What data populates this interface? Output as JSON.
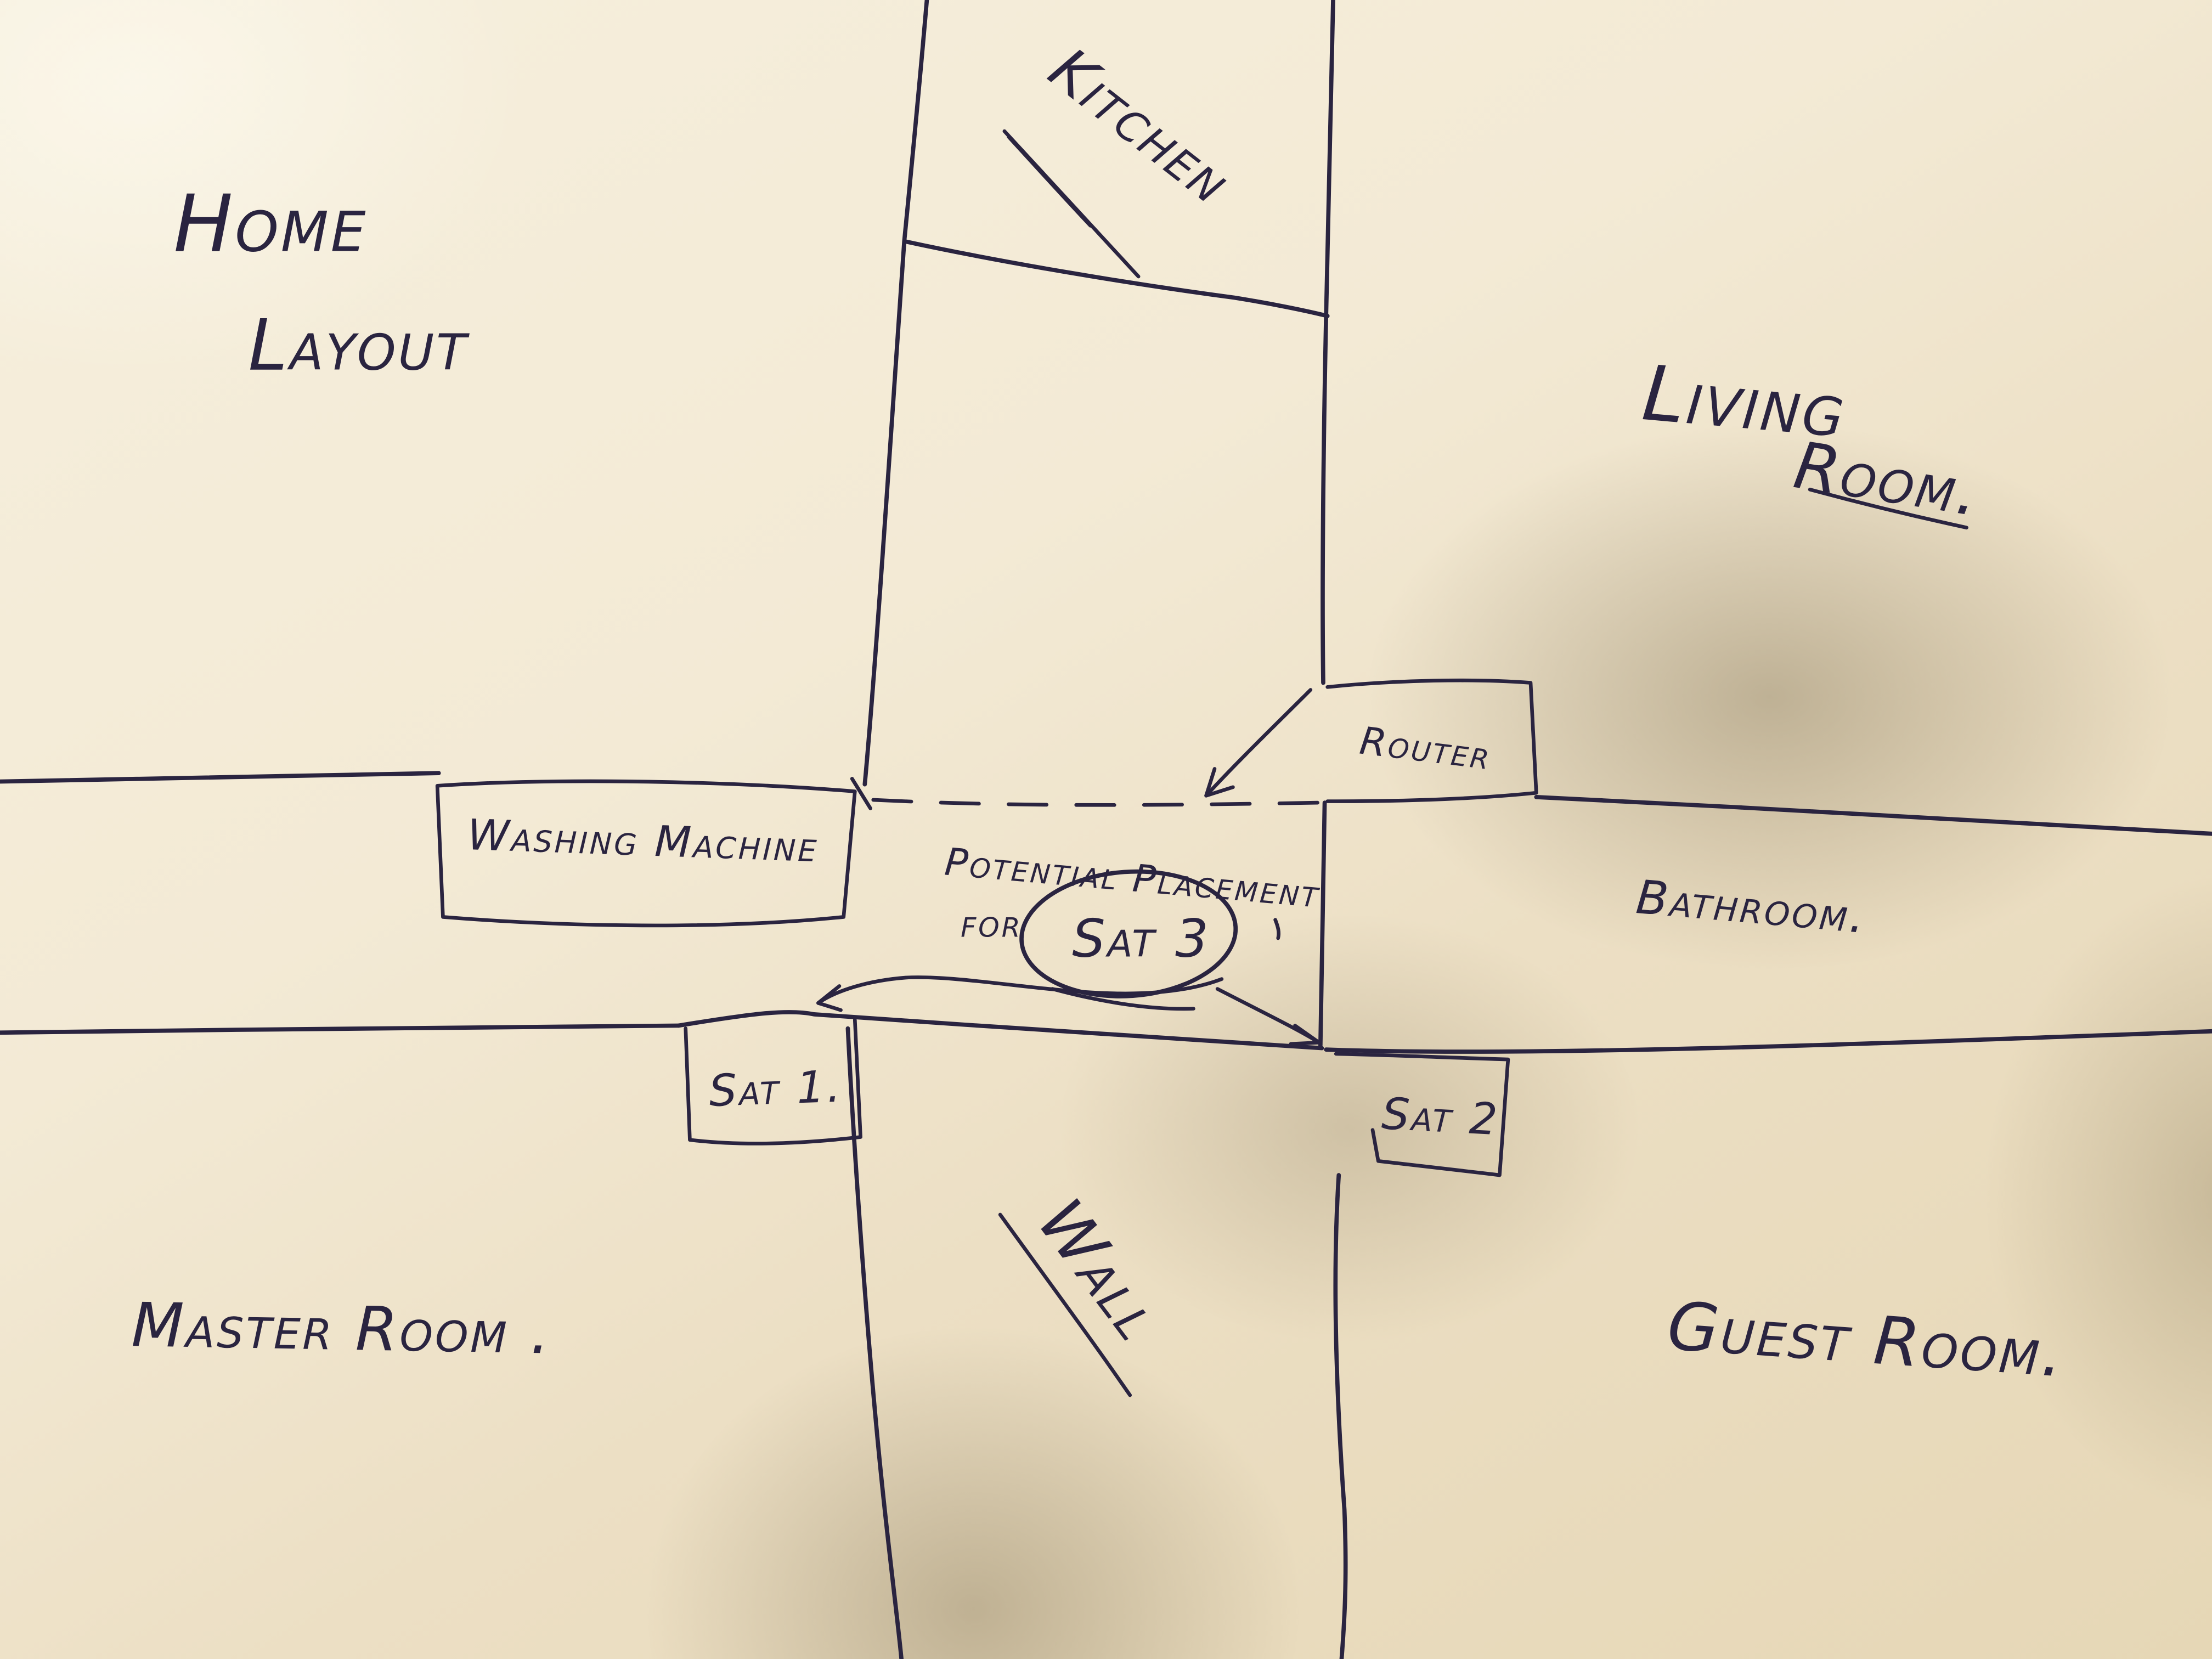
{
  "title": {
    "line1": "Home",
    "line2": "Layout"
  },
  "rooms": {
    "kitchen": "Kitchen",
    "living_room_line1": "Living",
    "living_room_line2": "Room.",
    "bathroom": "Bathroom.",
    "master_room": "Master Room .",
    "guest_room": "Guest Room.",
    "wall": "Wall"
  },
  "fixtures": {
    "washing_machine": "Washing Machine",
    "router": "Router",
    "sat_1": "Sat 1.",
    "sat_2": "Sat 2",
    "sat_3": "Sat 3"
  },
  "annotation": {
    "line1": "Potential Placement",
    "line2": "for"
  },
  "colors": {
    "ink": "#2a2440",
    "paper_light": "#f6efdd",
    "paper_shadow": "#b8a781"
  }
}
